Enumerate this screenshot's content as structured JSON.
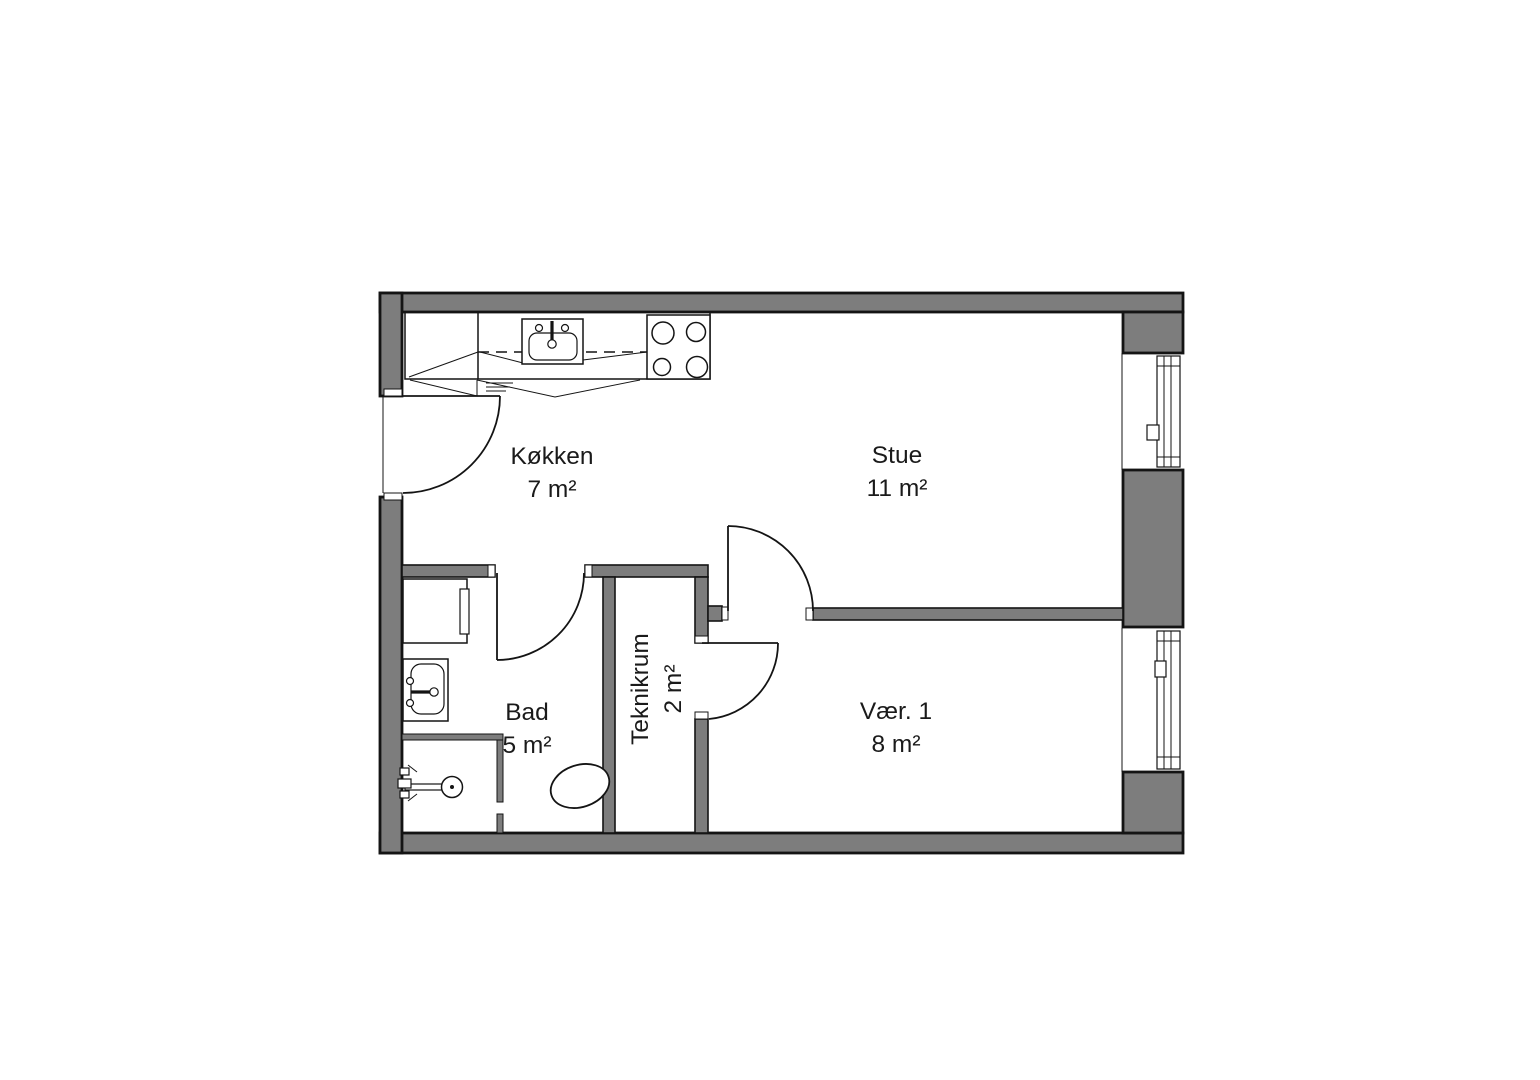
{
  "floorplan": {
    "rooms": [
      {
        "id": "kokken",
        "name": "Køkken",
        "area": "7 m²"
      },
      {
        "id": "stue",
        "name": "Stue",
        "area": "11 m²"
      },
      {
        "id": "bad",
        "name": "Bad",
        "area": "5 m²"
      },
      {
        "id": "teknikrum",
        "name": "Teknikrum",
        "area": "2 m²"
      },
      {
        "id": "vaer1",
        "name": "Vær. 1",
        "area": "8 m²"
      }
    ],
    "colors": {
      "wall_fill": "#7d7d7d",
      "line": "#141414",
      "background": "#ffffff"
    }
  }
}
